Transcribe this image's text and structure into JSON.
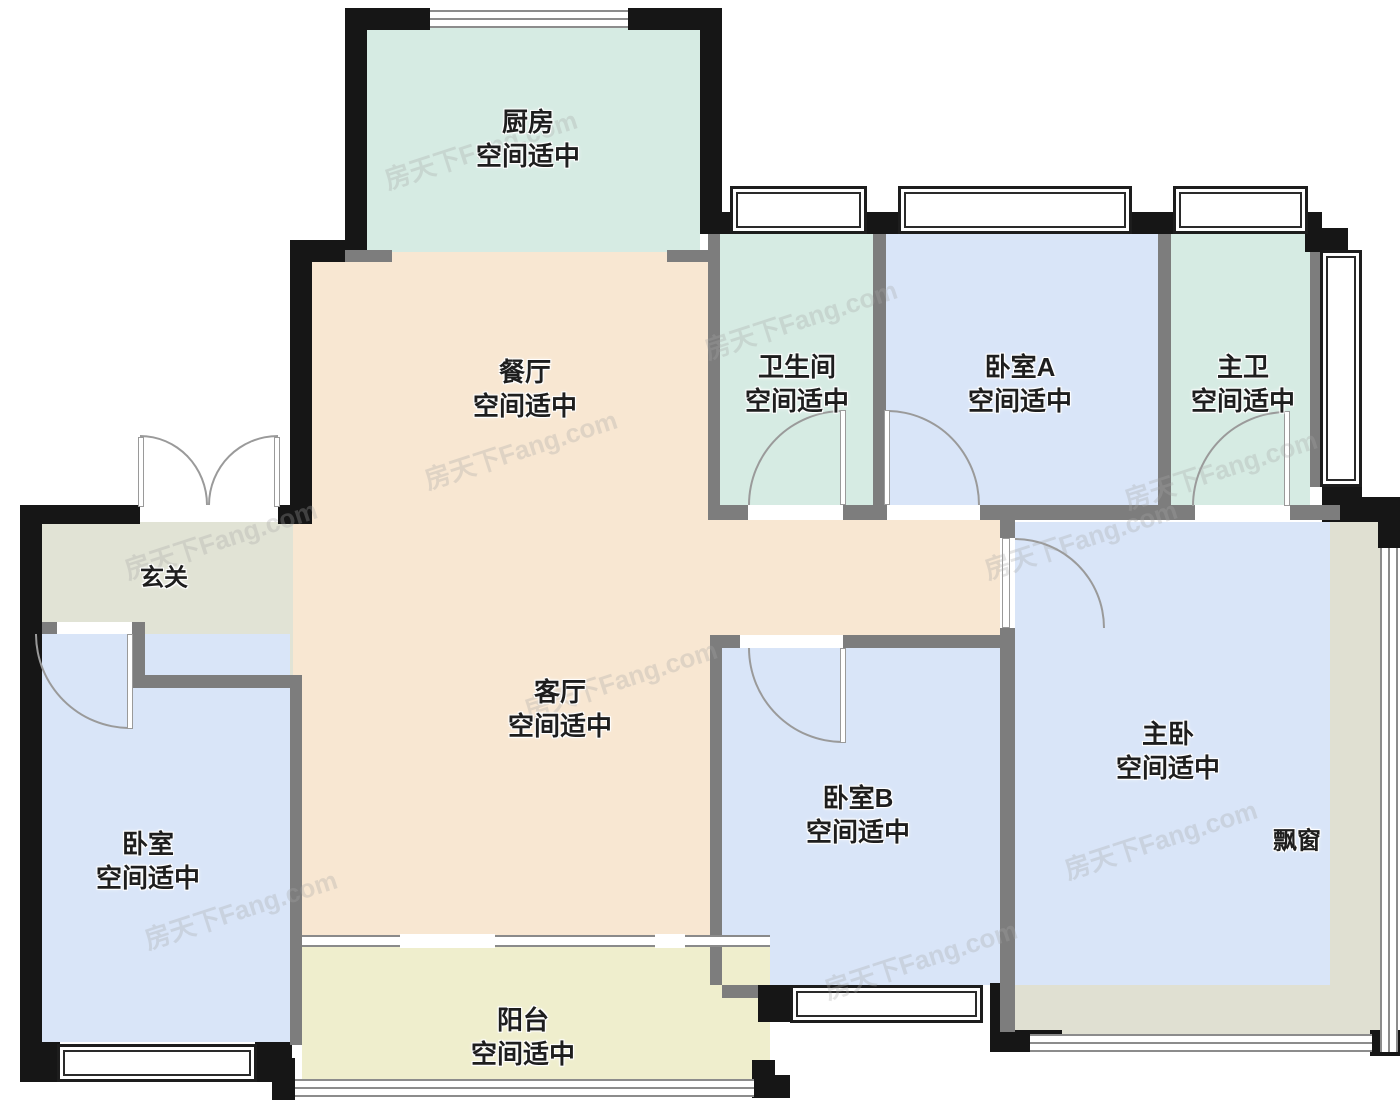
{
  "watermark_text": "房天下Fang.com",
  "palette": {
    "wall": "#161616",
    "inner_wall": "#7d7d7d",
    "kitchen_bath_fill": "#d6ebe3",
    "bedroom_fill": "#d9e5f8",
    "living_fill": "#f8e7d2",
    "foyer_fill": "#e1e3d5",
    "balcony_fill": "#efeecd",
    "bay_fill": "#e0e0d2"
  },
  "rooms": {
    "kitchen": {
      "name": "厨房",
      "status": "空间适中"
    },
    "dining": {
      "name": "餐厅",
      "status": "空间适中"
    },
    "bathroom": {
      "name": "卫生间",
      "status": "空间适中"
    },
    "bedroom_a": {
      "name": "卧室A",
      "status": "空间适中"
    },
    "master_bath": {
      "name": "主卫",
      "status": "空间适中"
    },
    "foyer": {
      "name": "玄关"
    },
    "living": {
      "name": "客厅",
      "status": "空间适中"
    },
    "bedroom": {
      "name": "卧室",
      "status": "空间适中"
    },
    "bedroom_b": {
      "name": "卧室B",
      "status": "空间适中"
    },
    "master_bedroom": {
      "name": "主卧",
      "status": "空间适中"
    },
    "bay_window": {
      "name": "飘窗"
    },
    "balcony": {
      "name": "阳台",
      "status": "空间适中"
    }
  }
}
